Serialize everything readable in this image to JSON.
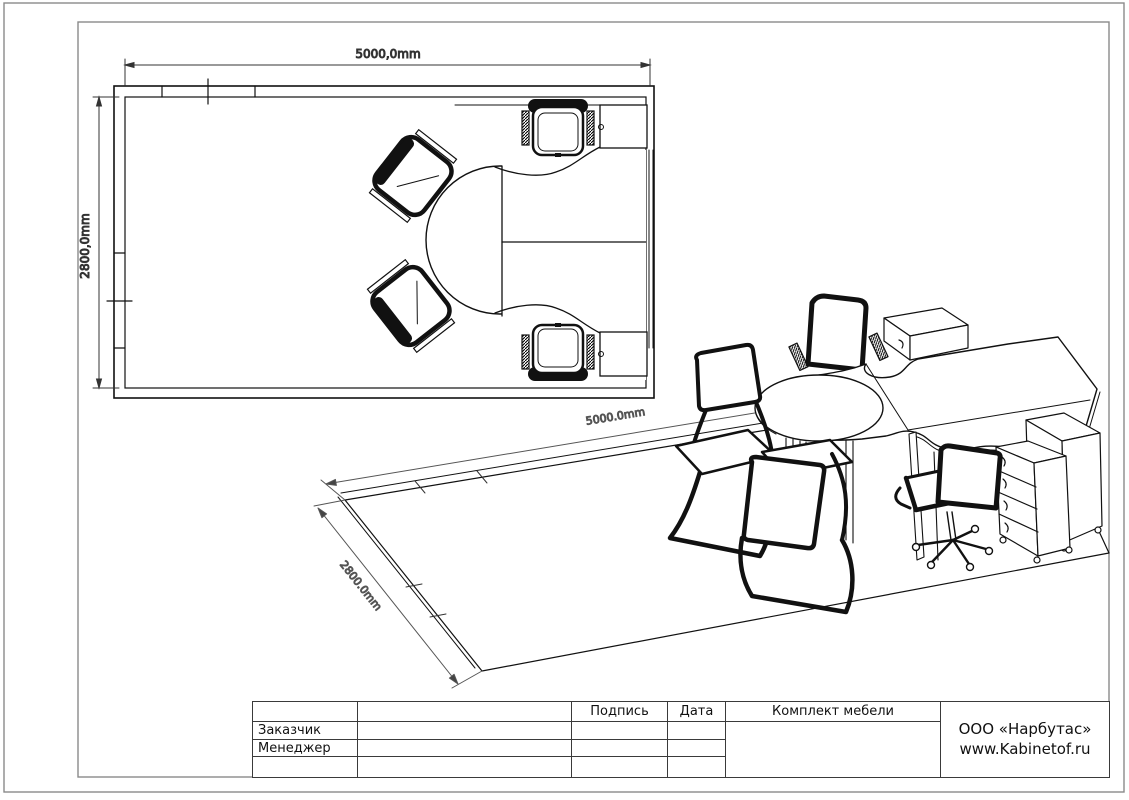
{
  "plan_view": {
    "width_dimension": "5000,0mm",
    "height_dimension": "2800,0mm"
  },
  "iso_view": {
    "width_dimension": "5000.0mm",
    "depth_dimension": "2800.0mm"
  },
  "title_block": {
    "signature_header": "Подпись",
    "date_header": "Дата",
    "customer_label": "Заказчик",
    "manager_label": "Менеджер",
    "project_title": "Комплект мебели",
    "company_name": "ООО «Нарбутас»",
    "company_website": "www.Kabinetof.ru"
  },
  "colors": {
    "drawing_line": "#1a1a1a",
    "frame_line": "#8a8a8a",
    "table_border": "#3a3a3a",
    "background": "#ffffff"
  }
}
